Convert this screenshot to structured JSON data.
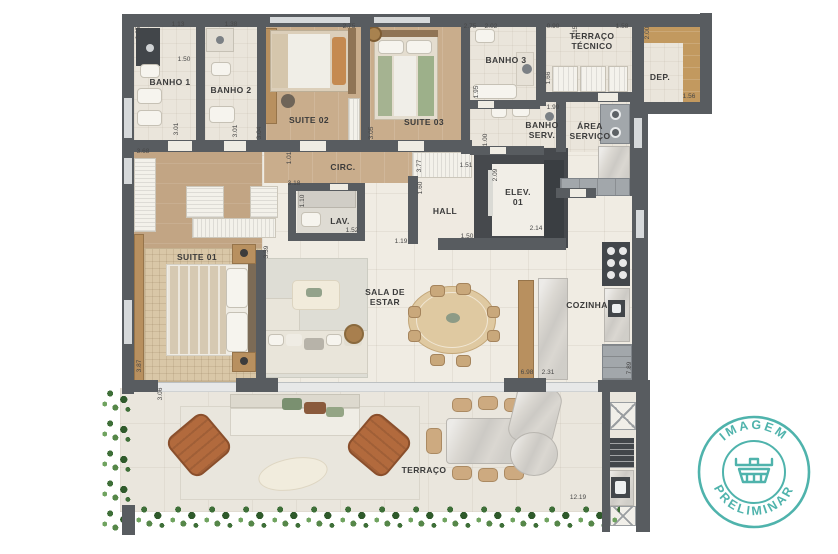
{
  "watermark": {
    "line1": "IMAGEM",
    "line2": "PRELIMINAR",
    "color": "#4fb3ac",
    "icon": "crown-icon"
  },
  "palette": {
    "wall": "#585c60",
    "wood_floor": "#c9ad8c",
    "tile_floor": "#f0ece3",
    "terrace_floor": "#eae6dd",
    "marble": "#dad7d1",
    "plants": "#3e6f38",
    "leather_chair": "#b26a3d",
    "watermark_teal": "#4fb3ac"
  },
  "rooms": [
    {
      "id": "banho-1",
      "label": "BANHO 1",
      "x": 170,
      "y": 82
    },
    {
      "id": "banho-2",
      "label": "BANHO 2",
      "x": 231,
      "y": 90
    },
    {
      "id": "suite-02",
      "label": "SUITE 02",
      "x": 309,
      "y": 120
    },
    {
      "id": "suite-03",
      "label": "SUITE 03",
      "x": 424,
      "y": 122
    },
    {
      "id": "banho-3",
      "label": "BANHO 3",
      "x": 506,
      "y": 60
    },
    {
      "id": "terraco-tecnico",
      "label": "TERRAÇO\nTÉCNICO",
      "x": 592,
      "y": 41
    },
    {
      "id": "dep",
      "label": "DEP.",
      "x": 660,
      "y": 77
    },
    {
      "id": "banho-serv",
      "label": "BANHO\nSERV.",
      "x": 542,
      "y": 130
    },
    {
      "id": "area-servico",
      "label": "ÁREA\nSERVIÇO",
      "x": 590,
      "y": 131
    },
    {
      "id": "circ",
      "label": "CIRC.",
      "x": 343,
      "y": 167
    },
    {
      "id": "lav",
      "label": "LAV.",
      "x": 340,
      "y": 221
    },
    {
      "id": "hall",
      "label": "HALL",
      "x": 445,
      "y": 211
    },
    {
      "id": "elev-01",
      "label": "ELEV.\n01",
      "x": 518,
      "y": 197
    },
    {
      "id": "suite-01",
      "label": "SUITE 01",
      "x": 197,
      "y": 257
    },
    {
      "id": "sala-de-estar",
      "label": "SALA DE\nESTAR",
      "x": 385,
      "y": 297
    },
    {
      "id": "cozinha",
      "label": "COZINHA",
      "x": 587,
      "y": 305
    },
    {
      "id": "terraco",
      "label": "TERRAÇO",
      "x": 424,
      "y": 470
    }
  ],
  "dimensions": [
    {
      "t": "0.65",
      "x": 139,
      "y": 33,
      "r": 1
    },
    {
      "t": "1.13",
      "x": 178,
      "y": 25,
      "r": 0
    },
    {
      "t": "1.50",
      "x": 184,
      "y": 60,
      "r": 0
    },
    {
      "t": "1.38",
      "x": 231,
      "y": 25,
      "r": 0
    },
    {
      "t": "3.01",
      "x": 177,
      "y": 129,
      "r": 1
    },
    {
      "t": "3.01",
      "x": 236,
      "y": 131,
      "r": 1
    },
    {
      "t": "3.04",
      "x": 260,
      "y": 133,
      "r": 1
    },
    {
      "t": "2.75",
      "x": 349,
      "y": 27,
      "r": 0
    },
    {
      "t": "2.75",
      "x": 470,
      "y": 27,
      "r": 0
    },
    {
      "t": "2.02",
      "x": 491,
      "y": 27,
      "r": 0
    },
    {
      "t": "0.90",
      "x": 553,
      "y": 27,
      "r": 0
    },
    {
      "t": "1.15",
      "x": 576,
      "y": 32,
      "r": 1
    },
    {
      "t": "1.58",
      "x": 622,
      "y": 27,
      "r": 0
    },
    {
      "t": "2.00",
      "x": 648,
      "y": 33,
      "r": 1
    },
    {
      "t": "1.56",
      "x": 689,
      "y": 97,
      "r": 0
    },
    {
      "t": "3.05",
      "x": 372,
      "y": 133,
      "r": 1
    },
    {
      "t": "1.95",
      "x": 477,
      "y": 92,
      "r": 1
    },
    {
      "t": "1.66",
      "x": 549,
      "y": 78,
      "r": 1
    },
    {
      "t": "1.99",
      "x": 553,
      "y": 108,
      "r": 0
    },
    {
      "t": "3.68",
      "x": 143,
      "y": 152,
      "r": 0
    },
    {
      "t": "1.01",
      "x": 290,
      "y": 158,
      "r": 1
    },
    {
      "t": "3.18",
      "x": 294,
      "y": 184,
      "r": 0
    },
    {
      "t": "1.10",
      "x": 303,
      "y": 201,
      "r": 1
    },
    {
      "t": "1.52",
      "x": 352,
      "y": 231,
      "r": 0
    },
    {
      "t": "3.77",
      "x": 420,
      "y": 166,
      "r": 1
    },
    {
      "t": "1.51",
      "x": 466,
      "y": 166,
      "r": 0
    },
    {
      "t": "1.60",
      "x": 421,
      "y": 188,
      "r": 1
    },
    {
      "t": "1.00",
      "x": 486,
      "y": 140,
      "r": 1
    },
    {
      "t": "2.09",
      "x": 496,
      "y": 175,
      "r": 1
    },
    {
      "t": "2.14",
      "x": 536,
      "y": 229,
      "r": 0
    },
    {
      "t": "1.50",
      "x": 467,
      "y": 237,
      "r": 0
    },
    {
      "t": "1.19",
      "x": 401,
      "y": 242,
      "r": 0
    },
    {
      "t": "3.39",
      "x": 267,
      "y": 252,
      "r": 1
    },
    {
      "t": "3.87",
      "x": 140,
      "y": 366,
      "r": 1
    },
    {
      "t": "3.06",
      "x": 161,
      "y": 394,
      "r": 1
    },
    {
      "t": "6.98",
      "x": 527,
      "y": 373,
      "r": 0
    },
    {
      "t": "2.31",
      "x": 548,
      "y": 373,
      "r": 0
    },
    {
      "t": "7.89",
      "x": 630,
      "y": 368,
      "r": 1
    },
    {
      "t": "12.19",
      "x": 578,
      "y": 498,
      "r": 0
    }
  ]
}
